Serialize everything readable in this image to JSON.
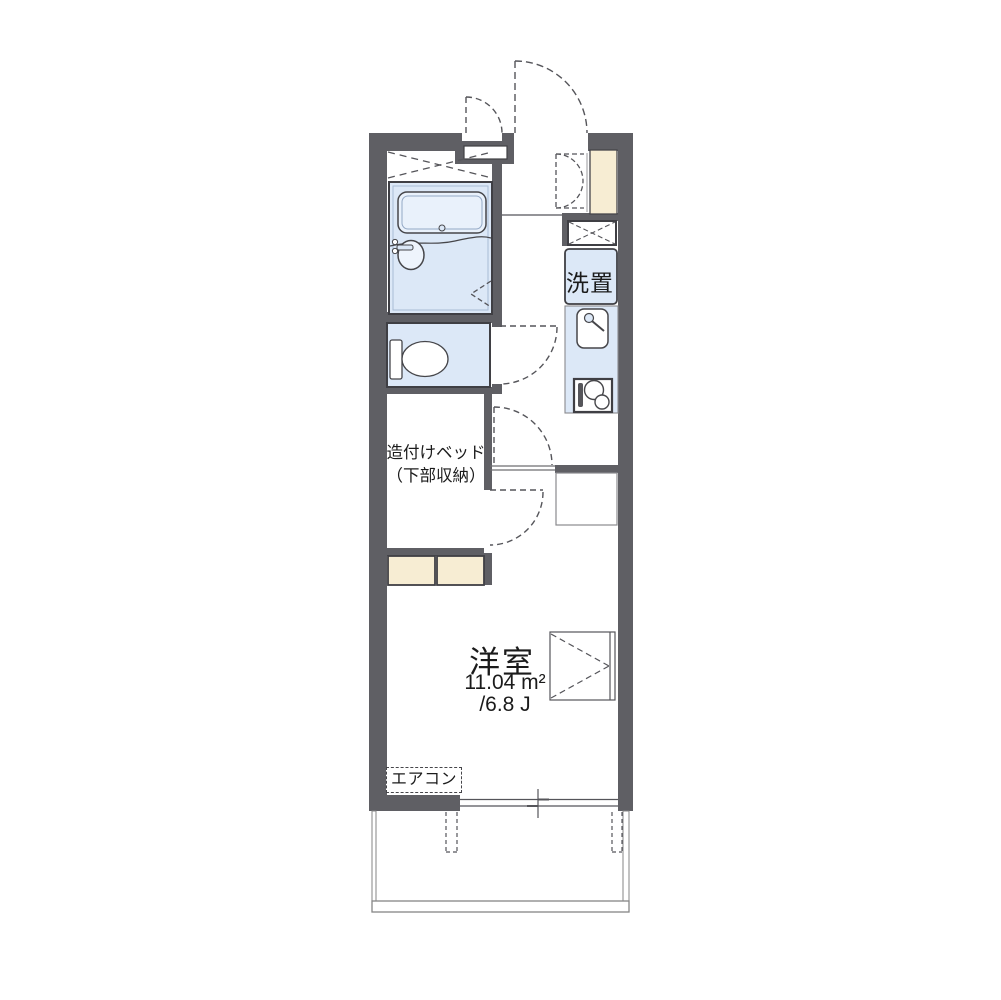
{
  "plan": {
    "type": "apartment-floor-plan",
    "labels": {
      "built_in_bed_line1": "造付けベッド",
      "built_in_bed_line2": "（下部収納）",
      "washer_place": "洗置",
      "western_room_name": "洋室",
      "western_room_area_sqm": "11.04 m²",
      "western_room_area_tatami": "/6.8 J",
      "air_conditioner": "エアコン"
    },
    "rooms": [
      {
        "name": "洋室",
        "area_sqm": "11.04 m²",
        "area_tatami": "6.8 J"
      },
      {
        "name": "造付けベッド（下部収納）"
      },
      {
        "name": "洗置"
      }
    ],
    "colors": {
      "wall": "#5f5f64",
      "water_fixture_fill": "#dce8f7",
      "cabinet_fill": "#f7edd3",
      "line_dark": "#3f3f44",
      "line_thin": "#55555a",
      "balcony_line": "#868686",
      "text": "#1b1b1b",
      "background": "#ffffff"
    }
  }
}
